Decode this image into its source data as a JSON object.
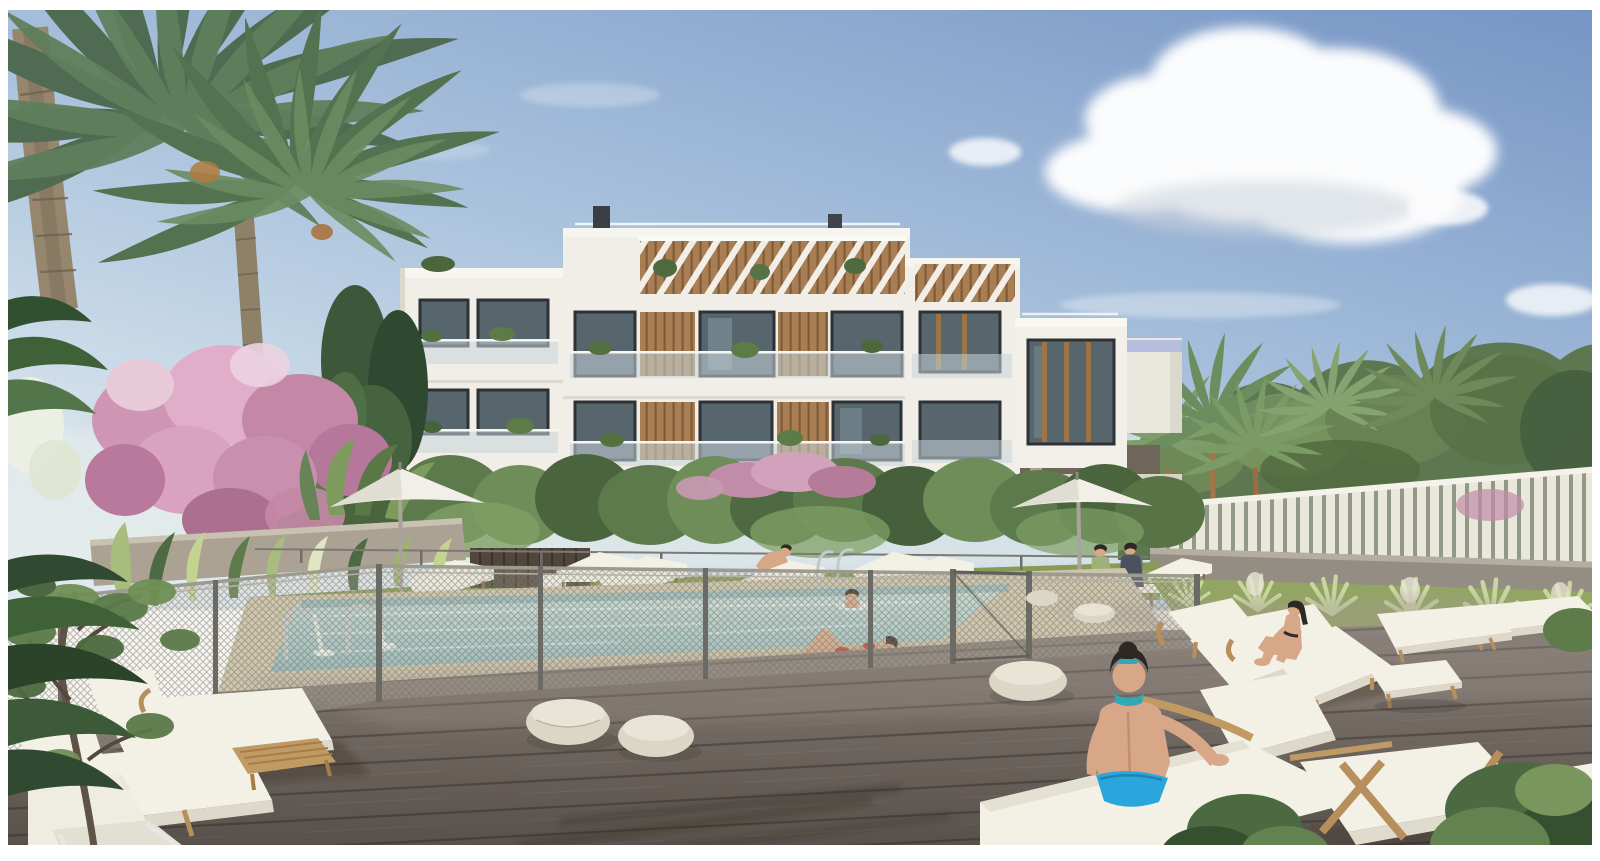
{
  "image": {
    "width": 1600,
    "height": 861,
    "border_color": "#ffffff"
  },
  "scene": {
    "type": "architectural-3d-rendering",
    "description": "Sunny exterior rendering of a new white Mediterranean apartment complex with a fenced communal swimming pool, wooden sun deck, sun loungers, parasols, palm trees and flowering gardens, with residents relaxing around the pool",
    "time_of_day": "daytime",
    "weather": "clear blue sky with one large cumulus cloud"
  },
  "objects": [
    {
      "name": "apartment-building",
      "label": "Modern white 4-storey apartment block with dark glazing, wooden louvre panels, glass balustrades and rooftop pergola"
    },
    {
      "name": "swimming-pool",
      "label": "Rectangular communal pool with two cascade water spouts and a ladder"
    },
    {
      "name": "pool-fence",
      "label": "Wire-mesh child-safety fence with metal posts and gate around the pool"
    },
    {
      "name": "wood-deck",
      "label": "Grey-brown plank sun deck in the foreground"
    },
    {
      "name": "sun-loungers",
      "label": "White cushioned timber sun loungers grouped on deck and lawn"
    },
    {
      "name": "parasols",
      "label": "Two white garden parasols"
    },
    {
      "name": "poufs",
      "label": "Round woven outdoor pouf stools"
    },
    {
      "name": "palm-trees",
      "label": "Tall date palms in the left foreground and background"
    },
    {
      "name": "bougainvillea",
      "label": "Pink flowering bougainvillea tree on the left"
    },
    {
      "name": "slat-fence",
      "label": "Light vertical-slat privacy fence along the right boundary"
    },
    {
      "name": "hedge-garden",
      "label": "Dense green hedges and planting at the building base"
    },
    {
      "name": "woman-sunbathing",
      "label": "Woman in a red bikini lying at the pool edge"
    },
    {
      "name": "woman-foreground",
      "label": "Woman with dark bun and blue bikini seated on a lounger, seen from behind"
    },
    {
      "name": "woman-on-lounger",
      "label": "Woman seated hugging her knees on a double lounger"
    },
    {
      "name": "child-in-pool",
      "label": "Child swimming in the pool"
    },
    {
      "name": "couple-on-bench",
      "label": "Couple seated on a bench under the right parasol"
    }
  ],
  "palette": {
    "sky-top": "#7795c5",
    "sky-mid": "#aac3dd",
    "sky-low": "#dfe9ef",
    "cloud": "#fbfcfd",
    "building-face": "#f0eee6",
    "building-shade": "#dcd8cd",
    "window-glass": "#57656d",
    "window-frame": "#2d3236",
    "pergola-wood": "#a87e52",
    "hedge": "#5d7a4c",
    "grass": "#93a562",
    "palm": "#5d7d5e",
    "bougainvillea": "#cf96b4",
    "pool-far": "#c9dfda",
    "pool-near": "#8fb8bb",
    "coping": "#cdc4aa",
    "wall": "#aba293",
    "slat": "#eae8dd",
    "deck-light": "#867d76",
    "deck-dark": "#554d47",
    "cushion": "#f3f0e6",
    "lounger-wood": "#c09a64",
    "pouf": "#dbd6c6",
    "umbrella": "#f1efe7",
    "skin": "#d7a787",
    "hair": "#2e2824",
    "bikini-red": "#c03a2c",
    "bikini-blue": "#2ba6dc",
    "scarf-teal": "#2fa9b8"
  }
}
